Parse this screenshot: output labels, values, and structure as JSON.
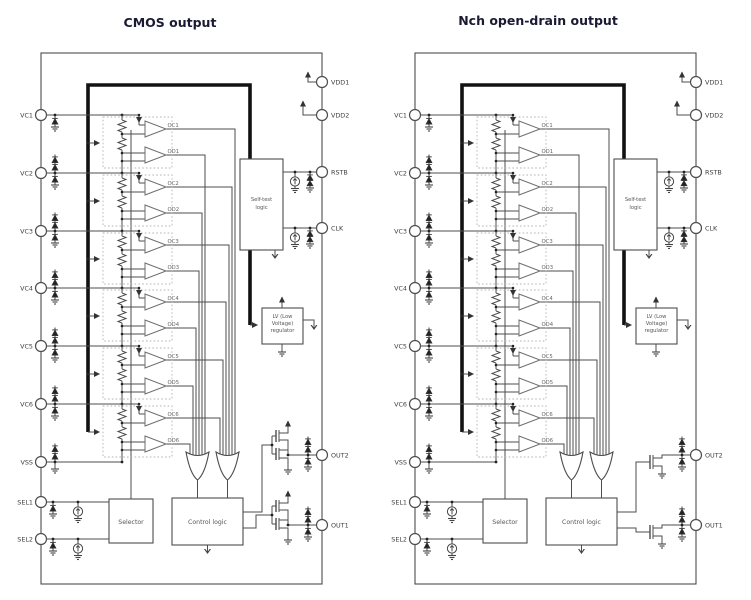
{
  "titles": {
    "left": "CMOS output",
    "right": "Nch open-drain output"
  },
  "pins": {
    "left": [
      "VC1",
      "VC2",
      "VC3",
      "VC4",
      "VC5",
      "VC6",
      "VSS",
      "SEL1",
      "SEL2"
    ],
    "right": [
      "VDD1",
      "VDD2",
      "RSTB",
      "CLK",
      "OUT2",
      "OUT1"
    ]
  },
  "comparators": [
    {
      "oc": "OC1",
      "od": "OD1"
    },
    {
      "oc": "OC2",
      "od": "OD2"
    },
    {
      "oc": "OC3",
      "od": "OD3"
    },
    {
      "oc": "OC4",
      "od": "OD4"
    },
    {
      "oc": "OC5",
      "od": "OD5"
    },
    {
      "oc": "OC6",
      "od": "OD6"
    }
  ],
  "blocks": {
    "self_test": [
      "Self-test",
      "logic"
    ],
    "lv_regulator": [
      "LV (Low",
      "Voltage)",
      "regulator"
    ],
    "selector": "Selector",
    "control_logic": "Control logic"
  },
  "colors": {
    "title": "#1a1a33",
    "wire": "#4d4d4d",
    "bus": "#121212",
    "background": "#ffffff"
  }
}
